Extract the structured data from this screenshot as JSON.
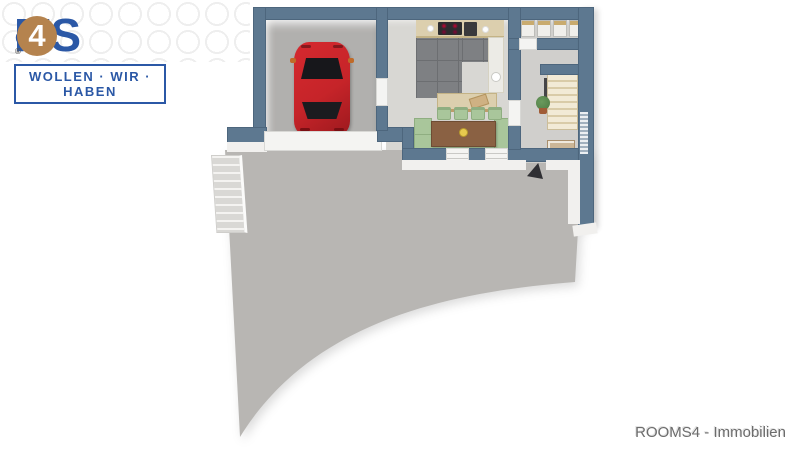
{
  "branding": {
    "logo_r": "R",
    "logo_o_top": "o",
    "logo_o_bottom": "o",
    "logo_ms": "MS",
    "logo_badge": "4",
    "registered": "®",
    "tagline": "WOLLEN · WIR · HABEN"
  },
  "footer": {
    "credit": "ROOMS4 - Immobilien"
  },
  "colors": {
    "logo_blue": "#2b58a6",
    "logo_tan": "#b5834e",
    "circle_pattern": "#ebebeb",
    "wall": "#5d7890",
    "wall_dark": "#4d667d",
    "garage_floor": "#b1b0ae",
    "driveway": "#b8b6b3",
    "kitchen_tile": "#7e8083",
    "kitchen_tile_line": "#6c6e71",
    "light_floor": "#d8d7d3",
    "hall_floor": "#d0cfcc",
    "car_red": "#c62429",
    "counter": "#dccfae",
    "wood": "#bd9d6b",
    "table_brown": "#8a6143",
    "seat_green": "#a9c69b",
    "seat_green_dark": "#8fae81",
    "stair_cream": "#eadfc4",
    "window_white": "#f4f4f2",
    "white_face": "#f1f0ee",
    "door_dark": "#2f2f33",
    "footer_text": "#6c6c6c"
  }
}
